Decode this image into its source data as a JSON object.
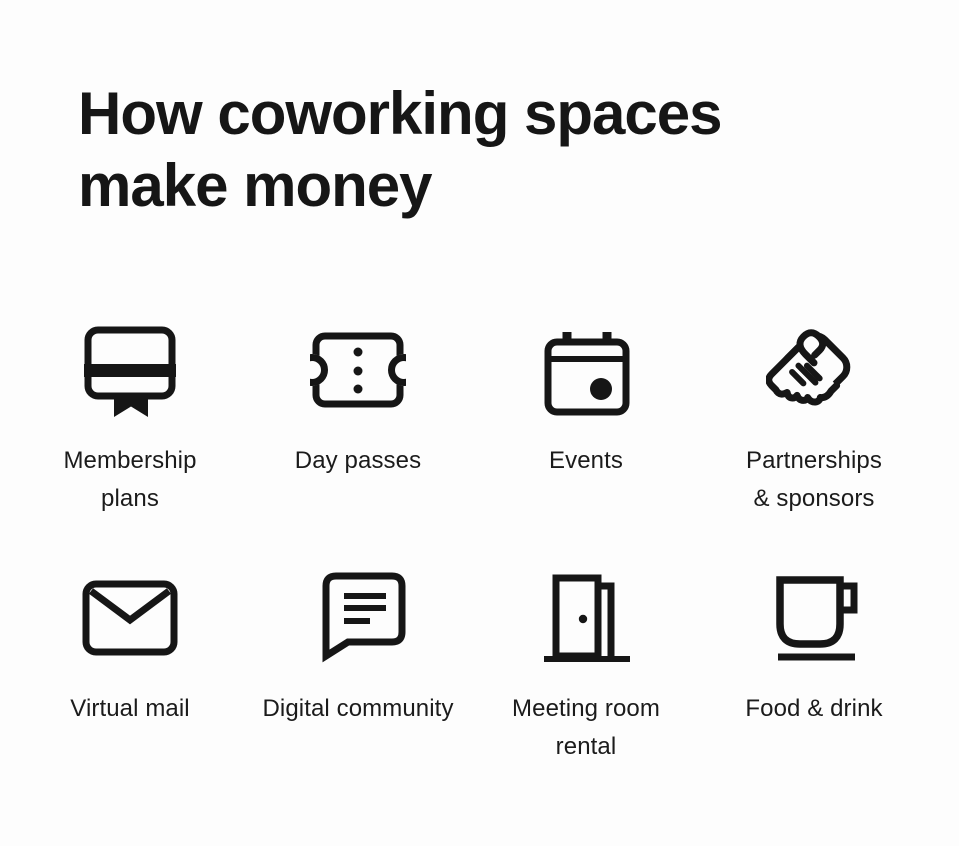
{
  "colors": {
    "background": "#fdfdfd",
    "ink": "#161616"
  },
  "header": {
    "title": "How coworking spaces make money"
  },
  "grid": {
    "items": [
      {
        "icon": "membership-card-icon",
        "label": "Membership plans",
        "lines": [
          "Membership",
          "plans"
        ]
      },
      {
        "icon": "ticket-icon",
        "label": "Day passes",
        "lines": [
          "Day passes"
        ]
      },
      {
        "icon": "calendar-icon",
        "label": "Events",
        "lines": [
          "Events"
        ]
      },
      {
        "icon": "handshake-icon",
        "label": "Partnerships & sponsors",
        "lines": [
          "Partnerships",
          "& sponsors"
        ]
      },
      {
        "icon": "envelope-icon",
        "label": "Virtual mail",
        "lines": [
          "Virtual mail"
        ]
      },
      {
        "icon": "chat-bubble-icon",
        "label": "Digital community",
        "lines": [
          "Digital community"
        ]
      },
      {
        "icon": "open-door-icon",
        "label": "Meeting room rental",
        "lines": [
          "Meeting room",
          "rental"
        ]
      },
      {
        "icon": "coffee-mug-icon",
        "label": "Food & drink",
        "lines": [
          "Food & drink"
        ]
      }
    ]
  }
}
